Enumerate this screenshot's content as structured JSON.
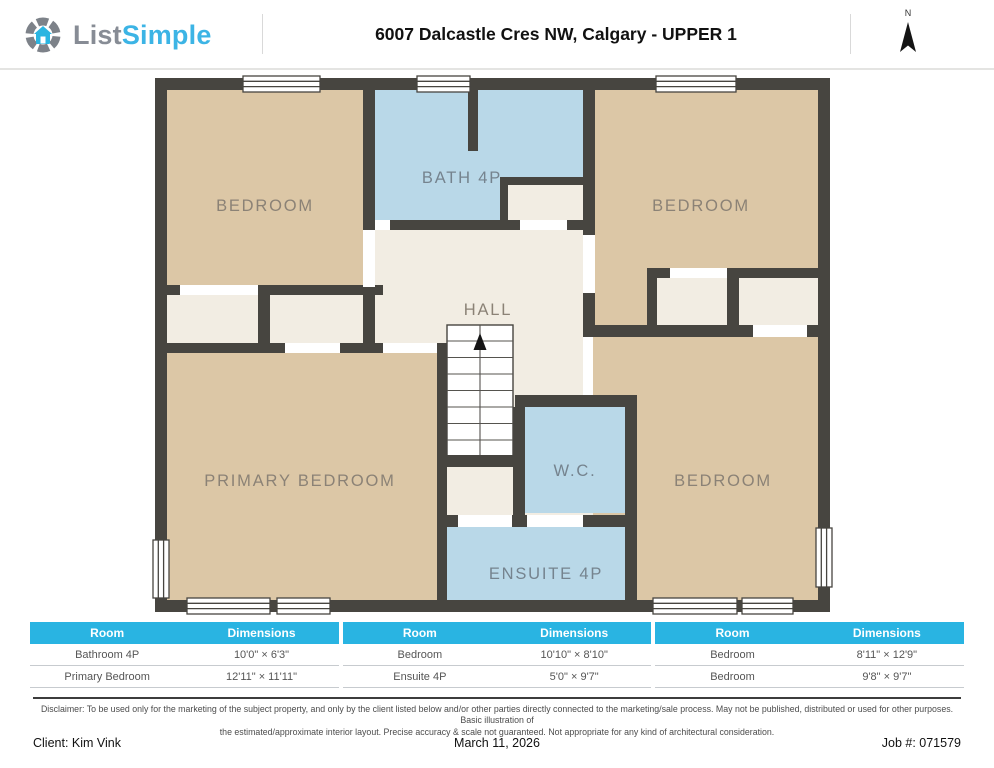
{
  "header": {
    "logo": {
      "list": "List",
      "simple": "Simple"
    },
    "title": "6007 Dalcastle Cres NW, Calgary - UPPER 1",
    "north_label": "N"
  },
  "plan": {
    "rooms": {
      "bedroom_top_left": "BEDROOM",
      "bath": "BATH 4P",
      "bedroom_top_right": "BEDROOM",
      "hall": "HALL",
      "primary_bedroom": "PRIMARY BEDROOM",
      "wc": "W.C.",
      "bedroom_bottom_right": "BEDROOM",
      "ensuite": "ENSUITE 4P"
    }
  },
  "table": {
    "col_room": "Room",
    "col_dimensions": "Dimensions",
    "groups": [
      {
        "rows": [
          {
            "room": "Bathroom 4P",
            "dim": "10'0\" × 6'3\""
          },
          {
            "room": "Primary Bedroom",
            "dim": "12'11\" × 11'11\""
          }
        ]
      },
      {
        "rows": [
          {
            "room": "Bedroom",
            "dim": "10'10\" × 8'10\""
          },
          {
            "room": "Ensuite 4P",
            "dim": "5'0\" × 9'7\""
          }
        ]
      },
      {
        "rows": [
          {
            "room": "Bedroom",
            "dim": "8'11\" × 12'9\""
          },
          {
            "room": "Bedroom",
            "dim": "9'8\" × 9'7\""
          }
        ]
      }
    ]
  },
  "disclaimer": {
    "line1": "Disclaimer: To be used only for the marketing of the subject property, and only by the client listed below and/or other parties directly connected to the marketing/sale process. May not be published, distributed or used for other purposes. Basic illustration of",
    "line2": "the estimated/approximate interior layout. Precise accuracy & scale not guaranteed. Not appropriate for any kind of architectural consideration."
  },
  "footer": {
    "client": "Client: Kim Vink",
    "date": "March 11, 2026",
    "job": "Job #: 071579"
  },
  "colors": {
    "accent": "#29B4E2",
    "wall": "#474540",
    "room_tan": "#DCC7A6",
    "room_blue": "#B9D8E8",
    "room_cream": "#F2EDE3",
    "label_gray": "#8B8276",
    "label_blue_gray": "#75838E"
  }
}
